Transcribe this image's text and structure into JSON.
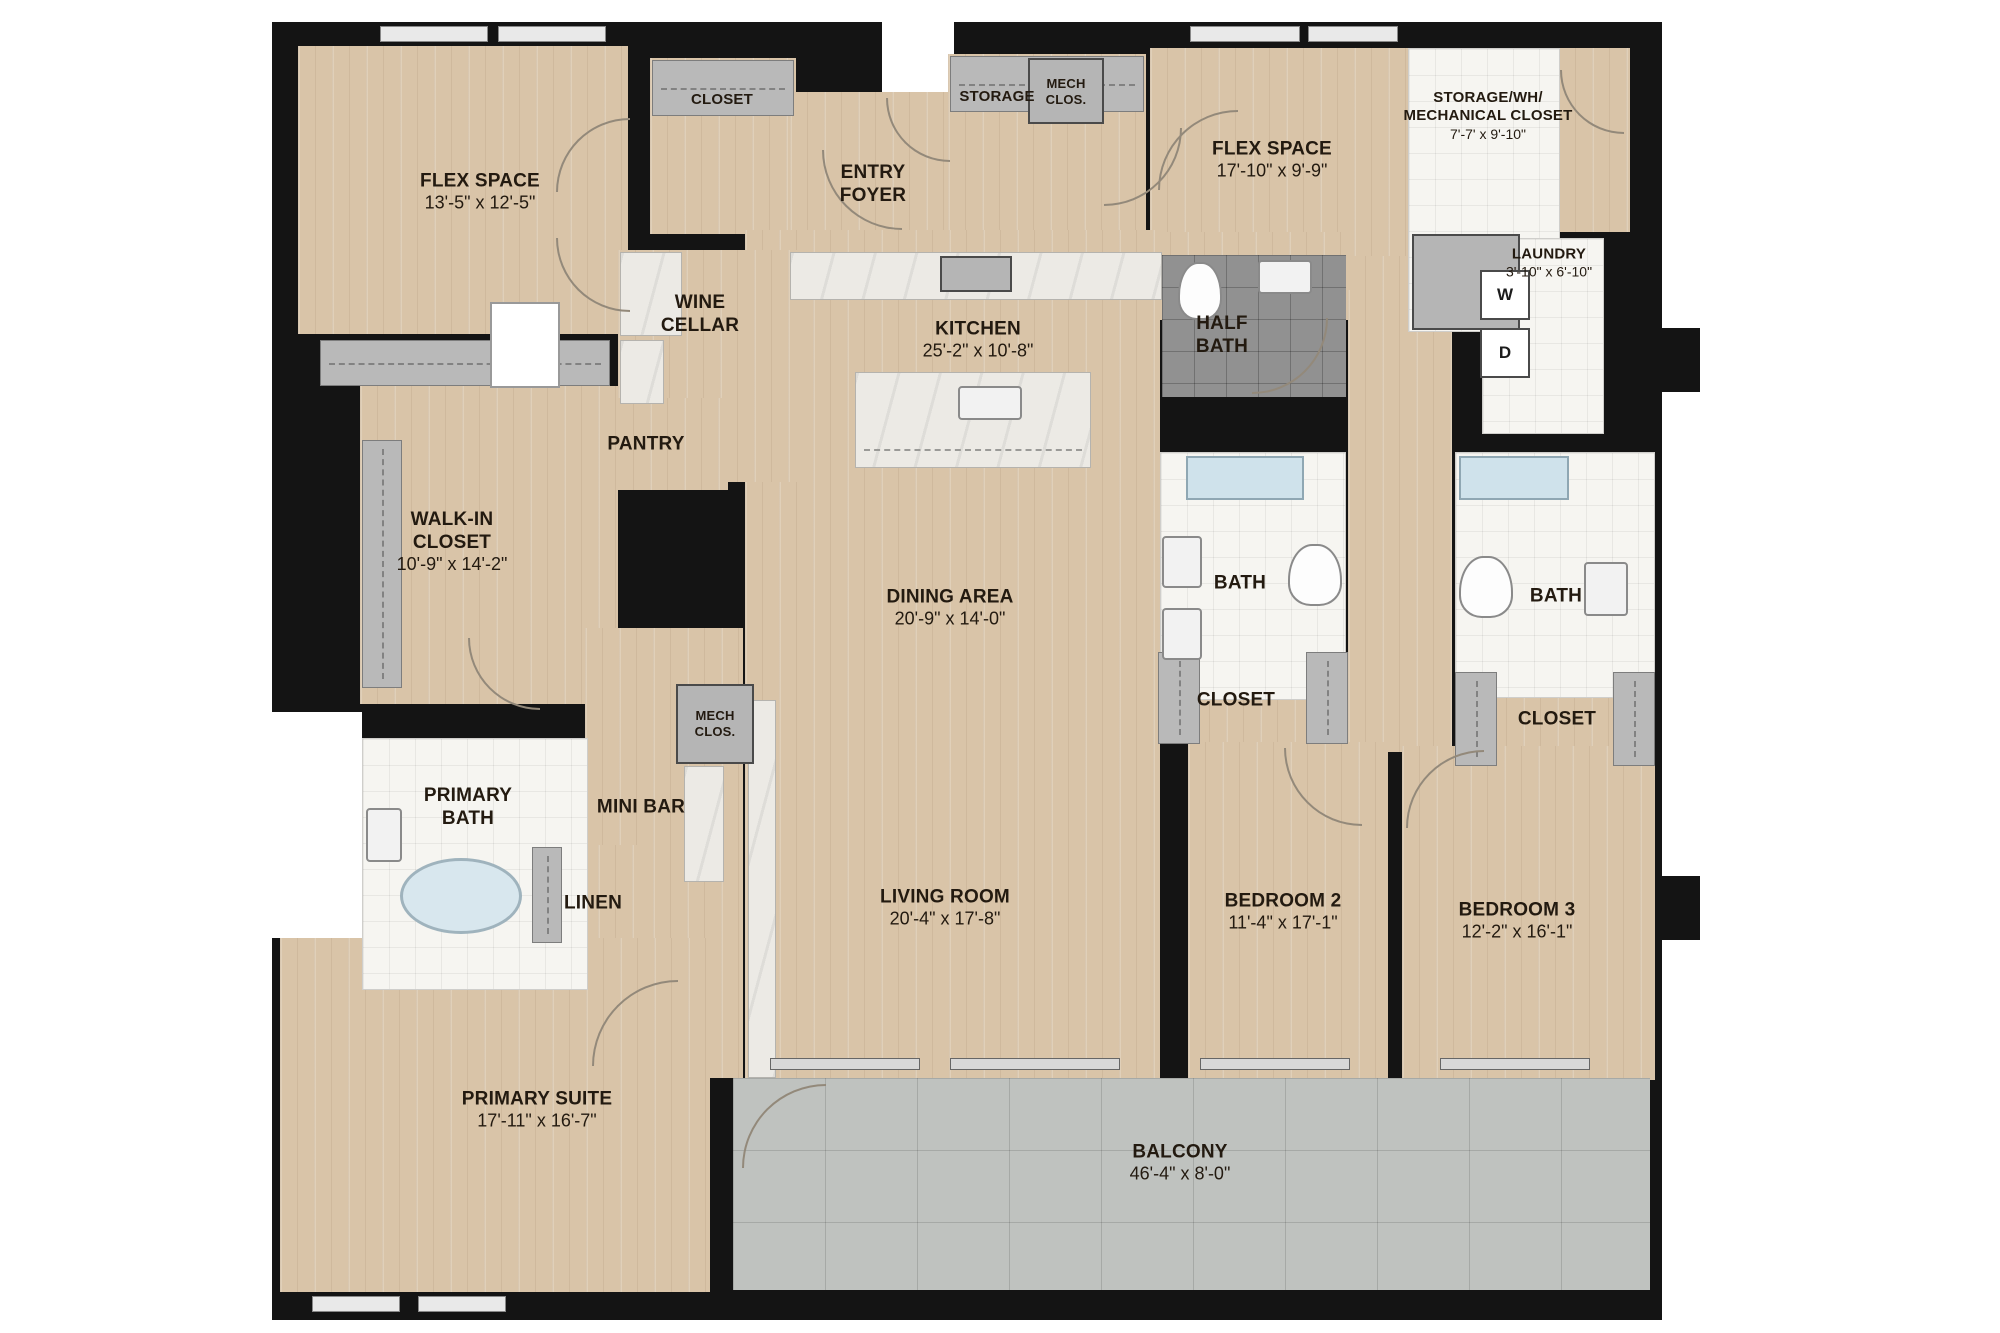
{
  "plan": {
    "rooms": [
      {
        "name": "FLEX SPACE",
        "dims": "13'-5\" x 12'-5\""
      },
      {
        "name": "CLOSET"
      },
      {
        "name": "ENTRY FOYER"
      },
      {
        "name": "STORAGE"
      },
      {
        "name": "MECH CLOS."
      },
      {
        "name": "FLEX SPACE",
        "dims": "17'-10\" x 9'-9\""
      },
      {
        "name": "STORAGE/WH/ MECHANICAL CLOSET",
        "dims": "7'-7' x 9'-10\""
      },
      {
        "name": "LAUNDRY",
        "dims": "3'-10\" x 6'-10\""
      },
      {
        "name": "WINE CELLAR"
      },
      {
        "name": "KITCHEN",
        "dims": "25'-2\" x 10'-8\""
      },
      {
        "name": "HALF BATH"
      },
      {
        "name": "PANTRY"
      },
      {
        "name": "WALK-IN CLOSET",
        "dims": "10'-9\" x 14'-2\""
      },
      {
        "name": "DINING AREA",
        "dims": "20'-9\" x 14'-0\""
      },
      {
        "name": "BATH"
      },
      {
        "name": "CLOSET"
      },
      {
        "name": "BATH"
      },
      {
        "name": "CLOSET"
      },
      {
        "name": "MECH CLOS."
      },
      {
        "name": "MINI BAR"
      },
      {
        "name": "PRIMARY BATH"
      },
      {
        "name": "LINEN"
      },
      {
        "name": "LIVING ROOM",
        "dims": "20'-4\" x 17'-8\""
      },
      {
        "name": "BEDROOM 2",
        "dims": "11'-4\" x 17'-1\""
      },
      {
        "name": "BEDROOM 3",
        "dims": "12'-2\" x 16'-1\""
      },
      {
        "name": "PRIMARY SUITE",
        "dims": "17'-11\" x 16'-7\""
      },
      {
        "name": "BALCONY",
        "dims": "46'-4\" x 8'-0\""
      }
    ],
    "appliances": {
      "washer": "W",
      "dryer": "D"
    },
    "colors": {
      "wall": "#141414",
      "floor": "#d9c4a8",
      "tile": "#f6f5f1",
      "dark_tile": "#919191",
      "fixture_gray": "#b5b5b5",
      "balcony": "#bfc2bf",
      "marble": "#eceae5"
    }
  }
}
